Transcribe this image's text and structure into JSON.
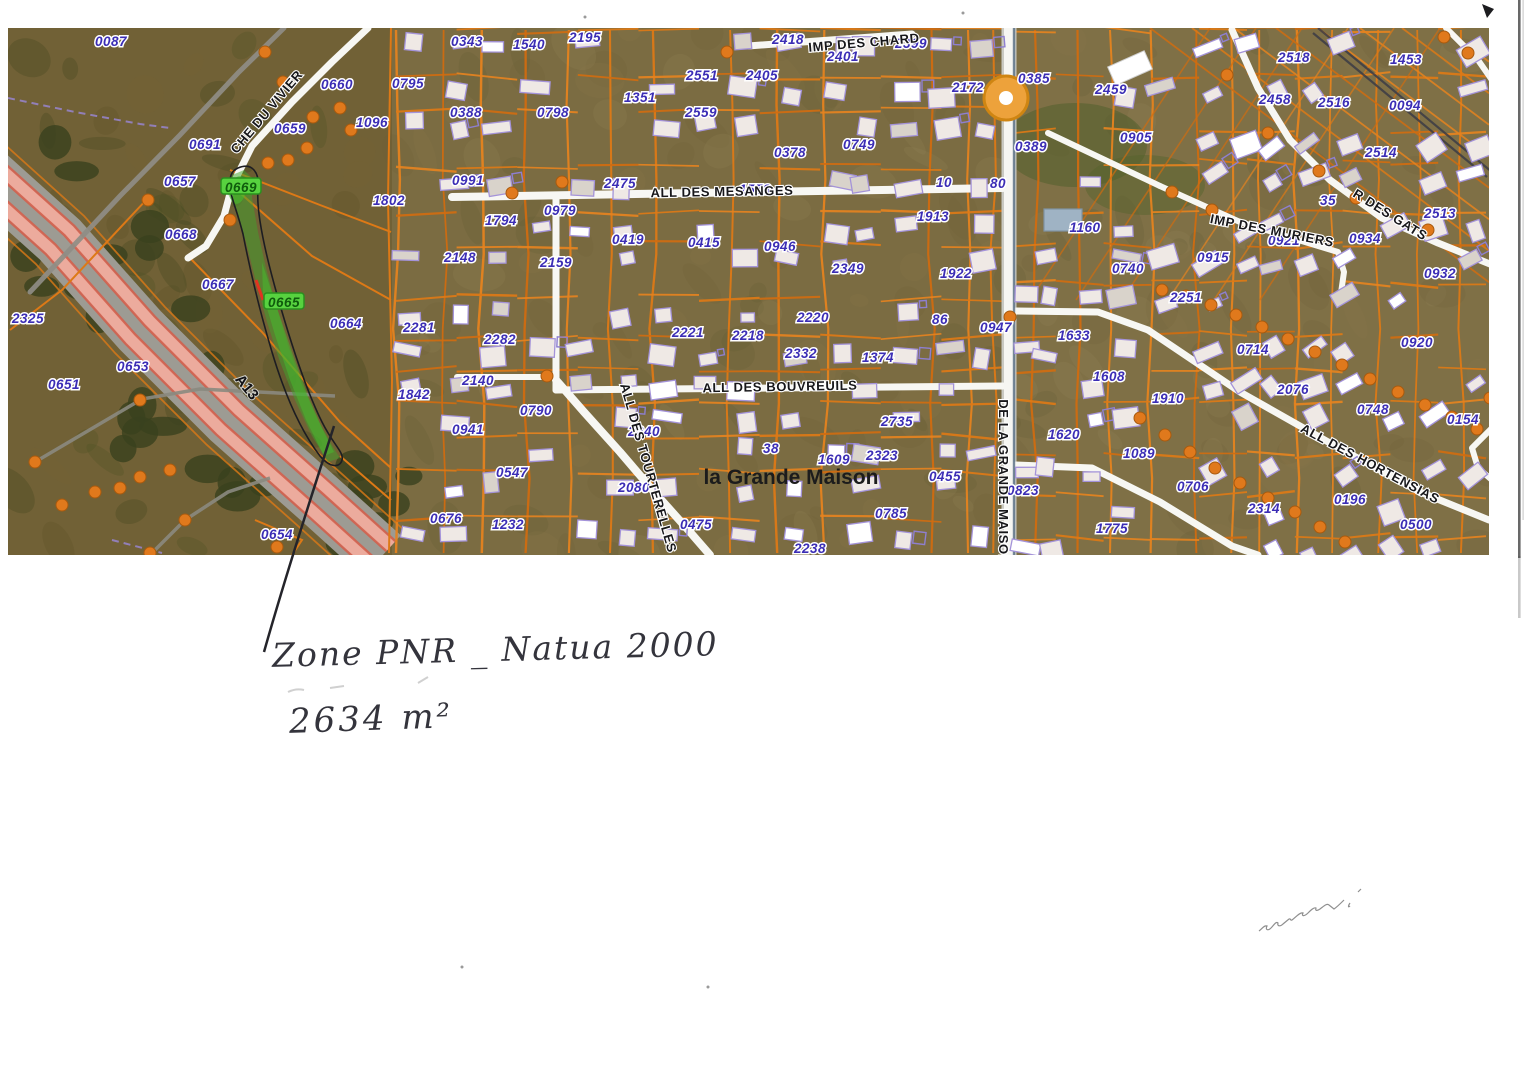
{
  "document": {
    "kind": "scanned cadastral aerial map with handwritten notes"
  },
  "annotations": {
    "zone_label": "Zone PNR _ Natua 2000",
    "area_label": "2634 m²"
  },
  "map": {
    "region_label": "la Grande Maison",
    "highway_label": "A13",
    "marker": {
      "type": "orange-circle",
      "x": 1006,
      "y": 98
    },
    "highlighted_parcels": [
      "0669",
      "0665"
    ],
    "streets": [
      {
        "label": "CHE DU VIVIER",
        "x": 267,
        "y": 112,
        "rot": -50
      },
      {
        "label": "IMP DES CHARD",
        "x": 864,
        "y": 43,
        "rot": -5
      },
      {
        "label": "ALL DES MESANGES",
        "x": 722,
        "y": 192,
        "rot": -1
      },
      {
        "label": "ALL DES BOUVREUILS",
        "x": 780,
        "y": 387,
        "rot": -1
      },
      {
        "label": "ALL DES TOURTERELLES",
        "x": 648,
        "y": 468,
        "rot": 74
      },
      {
        "label": "DE LA GRANDE MAISON",
        "x": 1003,
        "y": 482,
        "rot": 90
      },
      {
        "label": "R DES GATS",
        "x": 1390,
        "y": 215,
        "rot": 32
      },
      {
        "label": "IMP DES MURIERS",
        "x": 1272,
        "y": 231,
        "rot": 11
      },
      {
        "label": "ALL DES HORTENSIAS",
        "x": 1370,
        "y": 464,
        "rot": 28
      }
    ],
    "parcels": [
      [
        "0087",
        111,
        41
      ],
      [
        "0660",
        337,
        84
      ],
      [
        "0659",
        290,
        128
      ],
      [
        "1096",
        372,
        122
      ],
      [
        "0691",
        205,
        144
      ],
      [
        "0657",
        180,
        181
      ],
      [
        "0669",
        241,
        187,
        "g"
      ],
      [
        "1802",
        389,
        200
      ],
      [
        "0668",
        181,
        234
      ],
      [
        "0667",
        218,
        284
      ],
      [
        "0665",
        284,
        302,
        "g"
      ],
      [
        "0664",
        346,
        323
      ],
      [
        "2325",
        28,
        318
      ],
      [
        "0653",
        133,
        366
      ],
      [
        "0651",
        64,
        384
      ],
      [
        "0654",
        277,
        534
      ],
      [
        "0343",
        467,
        41
      ],
      [
        "1540",
        529,
        44
      ],
      [
        "2195",
        585,
        37
      ],
      [
        "0795",
        408,
        83
      ],
      [
        "0388",
        466,
        112
      ],
      [
        "0798",
        553,
        112
      ],
      [
        "1351",
        640,
        97
      ],
      [
        "2551",
        702,
        75
      ],
      [
        "2405",
        762,
        75
      ],
      [
        "2559",
        701,
        112
      ],
      [
        "2418",
        788,
        39
      ],
      [
        "2401",
        843,
        56
      ],
      [
        "2399",
        911,
        43
      ],
      [
        "2172",
        968,
        87
      ],
      [
        "0385",
        1034,
        78
      ],
      [
        "2459",
        1111,
        89
      ],
      [
        "0389",
        1031,
        146
      ],
      [
        "0905",
        1136,
        137
      ],
      [
        "0991",
        468,
        180
      ],
      [
        "2475",
        620,
        183
      ],
      [
        "1558",
        755,
        189
      ],
      [
        "0979",
        560,
        210
      ],
      [
        "1794",
        501,
        220
      ],
      [
        "0378",
        790,
        152
      ],
      [
        "0749",
        859,
        144
      ],
      [
        "10",
        944,
        182
      ],
      [
        "80",
        998,
        183
      ],
      [
        "0419",
        628,
        239
      ],
      [
        "0415",
        704,
        242
      ],
      [
        "0946",
        780,
        246
      ],
      [
        "2349",
        848,
        268
      ],
      [
        "1913",
        933,
        216
      ],
      [
        "1922",
        956,
        273
      ],
      [
        "2148",
        460,
        257
      ],
      [
        "2159",
        556,
        262
      ],
      [
        "0740",
        1128,
        268
      ],
      [
        "1160",
        1085,
        227
      ],
      [
        "2518",
        1294,
        57
      ],
      [
        "1453",
        1406,
        59
      ],
      [
        "2458",
        1275,
        99
      ],
      [
        "2516",
        1334,
        102
      ],
      [
        "0094",
        1405,
        105
      ],
      [
        "2514",
        1381,
        152
      ],
      [
        "2513",
        1440,
        213
      ],
      [
        "35",
        1328,
        200
      ],
      [
        "0934",
        1365,
        238
      ],
      [
        "0921",
        1284,
        240
      ],
      [
        "0915",
        1213,
        257
      ],
      [
        "0932",
        1440,
        273
      ],
      [
        "1633",
        1074,
        335
      ],
      [
        "1608",
        1109,
        376
      ],
      [
        "1620",
        1064,
        434
      ],
      [
        "1089",
        1139,
        453
      ],
      [
        "0823",
        1023,
        490
      ],
      [
        "1775",
        1112,
        528
      ],
      [
        "2251",
        1186,
        297
      ],
      [
        "0714",
        1253,
        349
      ],
      [
        "2076",
        1293,
        389
      ],
      [
        "1910",
        1168,
        398
      ],
      [
        "0920",
        1417,
        342
      ],
      [
        "0748",
        1373,
        409
      ],
      [
        "0154",
        1463,
        419
      ],
      [
        "0706",
        1193,
        486
      ],
      [
        "2314",
        1264,
        508
      ],
      [
        "0196",
        1350,
        499
      ],
      [
        "0500",
        1416,
        524
      ],
      [
        "2281",
        419,
        327
      ],
      [
        "2282",
        500,
        339
      ],
      [
        "2140",
        478,
        380
      ],
      [
        "1842",
        414,
        394
      ],
      [
        "0790",
        536,
        410
      ],
      [
        "0941",
        468,
        429
      ],
      [
        "0547",
        512,
        472
      ],
      [
        "0676",
        446,
        518
      ],
      [
        "1232",
        508,
        524
      ],
      [
        "2221",
        688,
        332
      ],
      [
        "2218",
        748,
        335
      ],
      [
        "2240",
        644,
        431
      ],
      [
        "2080",
        634,
        487
      ],
      [
        "0475",
        696,
        524
      ],
      [
        "38",
        771,
        448
      ],
      [
        "1609",
        834,
        459
      ],
      [
        "2323",
        882,
        455
      ],
      [
        "0455",
        945,
        476
      ],
      [
        "0785",
        891,
        513
      ],
      [
        "2238",
        810,
        548
      ],
      [
        "2220",
        813,
        317
      ],
      [
        "86",
        940,
        319
      ],
      [
        "0947",
        996,
        327
      ],
      [
        "2332",
        801,
        353
      ],
      [
        "1374",
        878,
        357
      ],
      [
        "2735",
        897,
        421
      ]
    ]
  },
  "colors": {
    "parcel_line": "#dd7916",
    "parcel_label": "#3b2db5",
    "highlight_green": "#3fa32c",
    "road": "#f7f7f3",
    "dot": "#e0791c",
    "highway_pink": "#ecab9d",
    "ink": "#34343c"
  }
}
